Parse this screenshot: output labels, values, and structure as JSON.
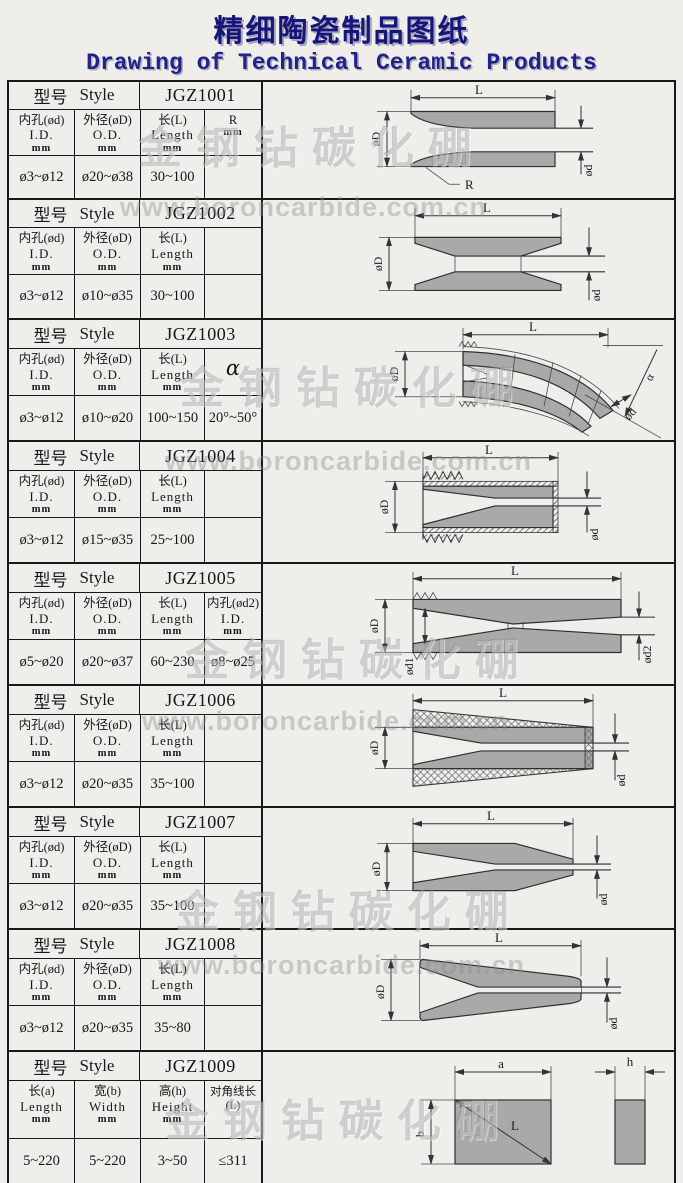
{
  "title": {
    "chinese": "精细陶瓷制品图纸",
    "english": "Drawing of Technical Ceramic Products"
  },
  "watermark": {
    "brand": "金钢钻碳化硼",
    "url": "www.boroncarbide.com.cn"
  },
  "common": {
    "style_cn": "型号",
    "style_en": "Style"
  },
  "sections": [
    {
      "model": "JGZ1001",
      "columns": [
        {
          "cn": "内孔(ød)",
          "en": "I.D.",
          "unit": "mm",
          "value": "ø3~ø12"
        },
        {
          "cn": "外径(øD)",
          "en": "O.D.",
          "unit": "mm",
          "value": "ø20~ø38"
        },
        {
          "cn": "长(L)",
          "en": "Length",
          "unit": "mm",
          "value": "30~100"
        },
        {
          "cn": "R",
          "en": "",
          "unit": "mm",
          "value": ""
        }
      ],
      "labels": {
        "L": "L",
        "oD": "øD",
        "od": "ød",
        "R": "R"
      }
    },
    {
      "model": "JGZ1002",
      "columns": [
        {
          "cn": "内孔(ød)",
          "en": "I.D.",
          "unit": "mm",
          "value": "ø3~ø12"
        },
        {
          "cn": "外径(øD)",
          "en": "O.D.",
          "unit": "mm",
          "value": "ø10~ø35"
        },
        {
          "cn": "长(L)",
          "en": "Length",
          "unit": "mm",
          "value": "30~100"
        },
        {
          "cn": "",
          "en": "",
          "unit": "",
          "value": ""
        }
      ],
      "labels": {
        "L": "L",
        "oD": "øD",
        "od": "ød"
      }
    },
    {
      "model": "JGZ1003",
      "columns": [
        {
          "cn": "内孔(ød)",
          "en": "I.D.",
          "unit": "mm",
          "value": "ø3~ø12"
        },
        {
          "cn": "外径(øD)",
          "en": "O.D.",
          "unit": "mm",
          "value": "ø10~ø20"
        },
        {
          "cn": "长(L)",
          "en": "Length",
          "unit": "mm",
          "value": "100~150"
        },
        {
          "cn": "α",
          "en": "",
          "unit": "",
          "value": "20°~50°"
        }
      ],
      "labels": {
        "L": "L",
        "oD": "øD",
        "od": "ød",
        "alpha": "α"
      }
    },
    {
      "model": "JGZ1004",
      "columns": [
        {
          "cn": "内孔(ød)",
          "en": "I.D.",
          "unit": "mm",
          "value": "ø3~ø12"
        },
        {
          "cn": "外径(øD)",
          "en": "O.D.",
          "unit": "mm",
          "value": "ø15~ø35"
        },
        {
          "cn": "长(L)",
          "en": "Length",
          "unit": "mm",
          "value": "25~100"
        },
        {
          "cn": "",
          "en": "",
          "unit": "",
          "value": ""
        }
      ],
      "labels": {
        "L": "L",
        "oD": "øD",
        "od": "ød"
      }
    },
    {
      "model": "JGZ1005",
      "columns": [
        {
          "cn": "内孔(ød)",
          "en": "I.D.",
          "unit": "mm",
          "value": "ø5~ø20"
        },
        {
          "cn": "外径(øD)",
          "en": "O.D.",
          "unit": "mm",
          "value": "ø20~ø37"
        },
        {
          "cn": "长(L)",
          "en": "Length",
          "unit": "mm",
          "value": "60~230"
        },
        {
          "cn": "内孔(ød2)",
          "en": "I.D.",
          "unit": "mm",
          "value": "ø8~ø25"
        }
      ],
      "labels": {
        "L": "L",
        "oD": "øD",
        "od1": "ød1",
        "od2": "ød2"
      }
    },
    {
      "model": "JGZ1006",
      "columns": [
        {
          "cn": "内孔(ød)",
          "en": "I.D.",
          "unit": "mm",
          "value": "ø3~ø12"
        },
        {
          "cn": "外径(øD)",
          "en": "O.D.",
          "unit": "mm",
          "value": "ø20~ø35"
        },
        {
          "cn": "长(L)",
          "en": "Length",
          "unit": "mm",
          "value": "35~100"
        },
        {
          "cn": "",
          "en": "",
          "unit": "",
          "value": ""
        }
      ],
      "labels": {
        "L": "L",
        "oD": "øD",
        "od": "ød"
      }
    },
    {
      "model": "JGZ1007",
      "columns": [
        {
          "cn": "内孔(ød)",
          "en": "I.D.",
          "unit": "mm",
          "value": "ø3~ø12"
        },
        {
          "cn": "外径(øD)",
          "en": "O.D.",
          "unit": "mm",
          "value": "ø20~ø35"
        },
        {
          "cn": "长(L)",
          "en": "Length",
          "unit": "mm",
          "value": "35~100"
        },
        {
          "cn": "",
          "en": "",
          "unit": "",
          "value": ""
        }
      ],
      "labels": {
        "L": "L",
        "oD": "øD",
        "od": "ød"
      }
    },
    {
      "model": "JGZ1008",
      "columns": [
        {
          "cn": "内孔(ød)",
          "en": "I.D.",
          "unit": "mm",
          "value": "ø3~ø12"
        },
        {
          "cn": "外径(øD)",
          "en": "O.D.",
          "unit": "mm",
          "value": "ø20~ø35"
        },
        {
          "cn": "长(L)",
          "en": "Length",
          "unit": "mm",
          "value": "35~80"
        },
        {
          "cn": "",
          "en": "",
          "unit": "",
          "value": ""
        }
      ],
      "labels": {
        "L": "L",
        "oD": "øD",
        "od": "ød"
      }
    },
    {
      "model": "JGZ1009",
      "columns": [
        {
          "cn": "长(a)",
          "en": "Length",
          "unit": "mm",
          "value": "5~220"
        },
        {
          "cn": "宽(b)",
          "en": "Width",
          "unit": "mm",
          "value": "5~220"
        },
        {
          "cn": "高(h)",
          "en": "Height",
          "unit": "mm",
          "value": "3~50"
        },
        {
          "cn": "对角线长 (L)",
          "en": "",
          "unit": "",
          "value": "≤311"
        }
      ],
      "labels": {
        "a": "a",
        "b": "b",
        "h": "h",
        "L": "L"
      }
    }
  ]
}
